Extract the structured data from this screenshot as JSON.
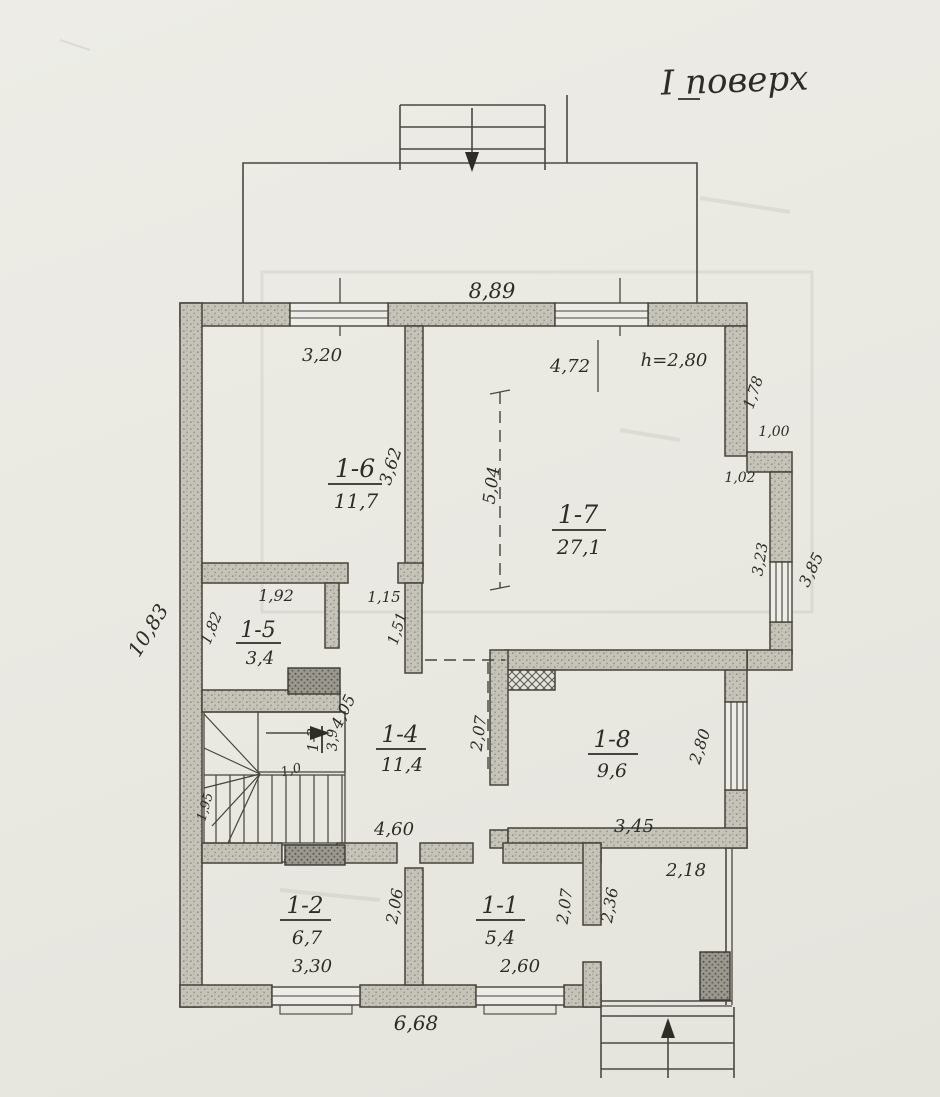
{
  "title": "І поверх",
  "rooms": {
    "r16": {
      "id": "1-6",
      "area": "11,7"
    },
    "r17": {
      "id": "1-7",
      "area": "27,1"
    },
    "r15": {
      "id": "1-5",
      "area": "3,4"
    },
    "r14": {
      "id": "1-4",
      "area": "11,4"
    },
    "r18": {
      "id": "1-8",
      "area": "9,6"
    },
    "r13": {
      "id": "1-3",
      "area": "3,9"
    },
    "r12": {
      "id": "1-2",
      "area": "6,7"
    },
    "r11": {
      "id": "1-1",
      "area": "5,4"
    }
  },
  "dims": {
    "overall_width": "8,89",
    "overall_height": "10,83",
    "bottom_width": "6,68",
    "r16_width": "3,20",
    "r16_depth": "3,62",
    "r17_width": "4,72",
    "r17_depth": "5,04",
    "ceiling_height": "h=2,80",
    "right_notch_depth": "1,78",
    "right_notch_width": "1,00",
    "right_notch_inner": "1,02",
    "right_window_inner": "3,23",
    "right_window_outer": "3,85",
    "r15_width": "1,92",
    "r15_depth": "1,82",
    "hall_opening": "1,15",
    "hall_stub": "1,51",
    "hall_depth": "4,05",
    "hall_width": "4,60",
    "hall_pass": "2,07",
    "stair_side": "1,95",
    "stair_flight": "1,0",
    "r18_width": "3,45",
    "r18_depth": "2,80",
    "r12_width": "3,30",
    "r12_depth": "2,06",
    "r11_width": "2,60",
    "r11_depth": "2,07",
    "porch_width": "2,18",
    "porch_depth": "2,36"
  }
}
